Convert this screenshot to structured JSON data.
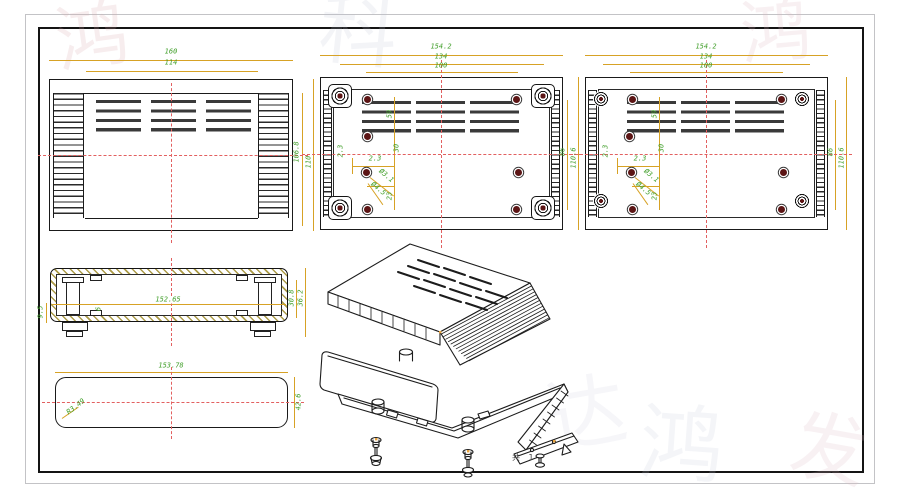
{
  "sheet": {
    "page_label": "共 1"
  },
  "watermark": {
    "g1": "鸿",
    "g2": "科",
    "g3": "达",
    "g4": "鸿",
    "g5": "发",
    "g6": "鸿"
  },
  "colors": {
    "dim_text": "#3f9e28",
    "dim_line": "#d7a225",
    "center_line": "#e26060",
    "drawing_line": "#1a1a1a",
    "screw_fill": "#5c1515"
  },
  "views": {
    "front": {
      "dims": {
        "outer_width": "160",
        "inner_width": "114",
        "inner_height": "106.8",
        "outer_height": "110"
      }
    },
    "bottom": {
      "dims": {
        "outer_width": "154.2",
        "mid_width": "134",
        "screw_span": "100",
        "inner_height": "86",
        "outer_height": "110.6",
        "vent_span": "59",
        "center_offset": "30",
        "foot_offset_x": "2.3",
        "foot_offset_y": "2.3",
        "hole_dia": "Ø3.1",
        "boss_dia": "Ø4.5",
        "hole_span": "23"
      }
    },
    "top": {
      "dims": {
        "outer_width": "154.2",
        "mid_width": "134",
        "screw_span": "100",
        "inner_height": "86",
        "outer_height": "110.6",
        "vent_span": "59",
        "center_offset": "30",
        "foot_offset_x": "2.3",
        "foot_offset_y": "2.3",
        "hole_dia": "Ø3.1",
        "boss_dia": "Ø4.5",
        "hole_span": "23"
      }
    },
    "section": {
      "dims": {
        "width": "152.65",
        "foot_height": "9.5",
        "wall": "6",
        "inner_height": "30.8",
        "outer_height": "36.2"
      }
    },
    "panel": {
      "dims": {
        "width": "153.78",
        "corner_radius": "R3.49",
        "height": "42.6"
      }
    }
  }
}
